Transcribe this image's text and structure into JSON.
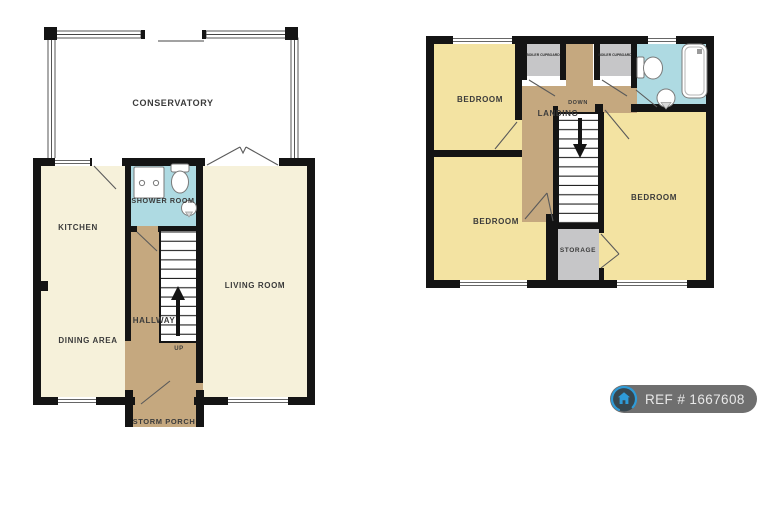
{
  "plans": {
    "ground_floor": {
      "labels": {
        "conservatory": "CONSERVATORY",
        "kitchen": "KITCHEN",
        "shower_room": "SHOWER ROOM",
        "living_room": "LIVING ROOM",
        "dining_area": "DINING AREA",
        "hallway": "HALLWAY",
        "up": "UP",
        "storm_porch": "STORM PORCH"
      }
    },
    "first_floor": {
      "labels": {
        "bedroom_top_left": "BEDROOM",
        "bedroom_bottom_left": "BEDROOM",
        "bedroom_right": "BEDROOM",
        "landing": "LANDING",
        "down": "DOWN",
        "boiler_cupboard_left": "BOILER CUPBOARD",
        "boiler_cupboard_right": "BOILER CUPBOARD",
        "storage": "STORAGE"
      }
    }
  },
  "badge": {
    "ref": "REF # 1667608"
  },
  "palette": {
    "room_cream": "#F6F1DA",
    "room_yellow": "#F3E3A2",
    "hall_tan": "#C5A87F",
    "bath_blue": "#AEDAE2",
    "cupboard_gray": "#C6C6C8",
    "wall_black": "#141414",
    "label_gray": "#3B3B3B",
    "badge_gray": "#6F6F6F",
    "badge_circle_navy": "#37474F",
    "badge_accent_blue": "#2E9BD8",
    "badge_text": "#E8E8E8"
  }
}
